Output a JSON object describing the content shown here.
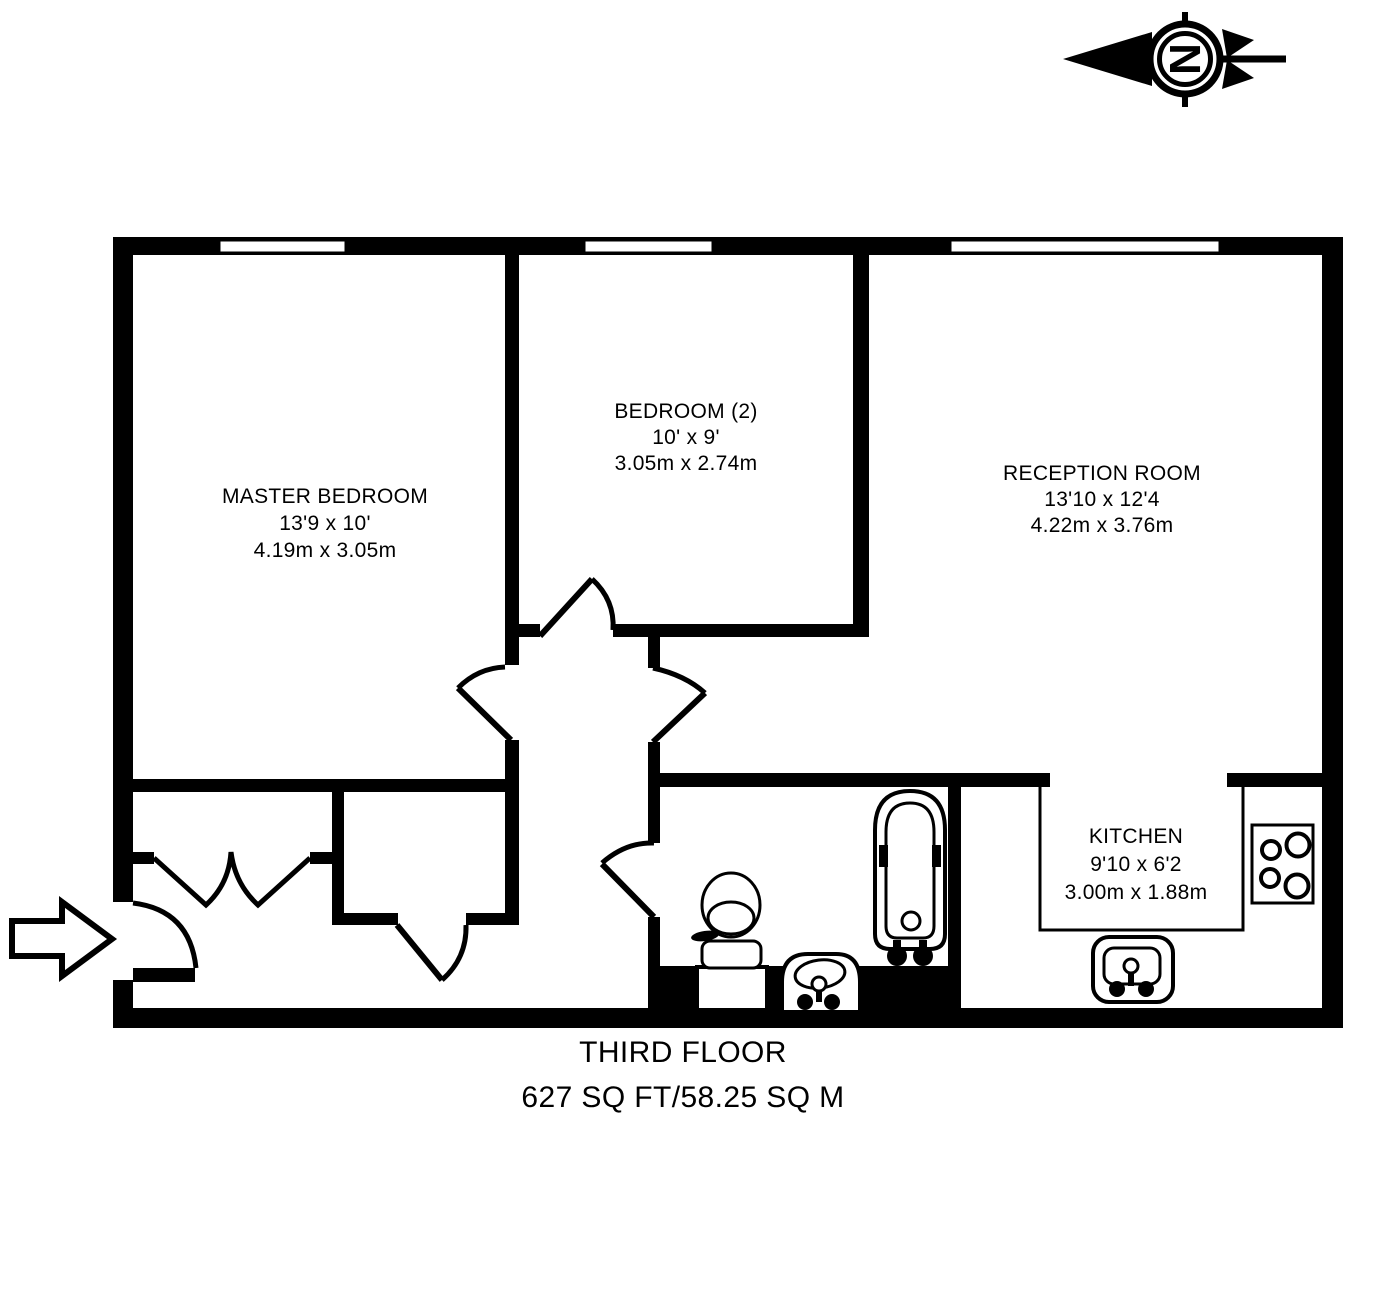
{
  "compass": {
    "letter": "N"
  },
  "rooms": [
    {
      "name": "MASTER BEDROOM",
      "imperial": "13'9 x 10'",
      "metric": "4.19m x 3.05m"
    },
    {
      "name": "BEDROOM (2)",
      "imperial": "10' x 9'",
      "metric": "3.05m x 2.74m"
    },
    {
      "name": "RECEPTION ROOM",
      "imperial": "13'10 x 12'4",
      "metric": "4.22m x 3.76m"
    },
    {
      "name": "KITCHEN",
      "imperial": "9'10 x 6'2",
      "metric": "3.00m x 1.88m"
    }
  ],
  "footer": {
    "floor": "THIRD FLOOR",
    "area": "627 SQ FT/58.25 SQ M"
  },
  "colors": {
    "ink": "#000000",
    "paper": "#ffffff"
  }
}
